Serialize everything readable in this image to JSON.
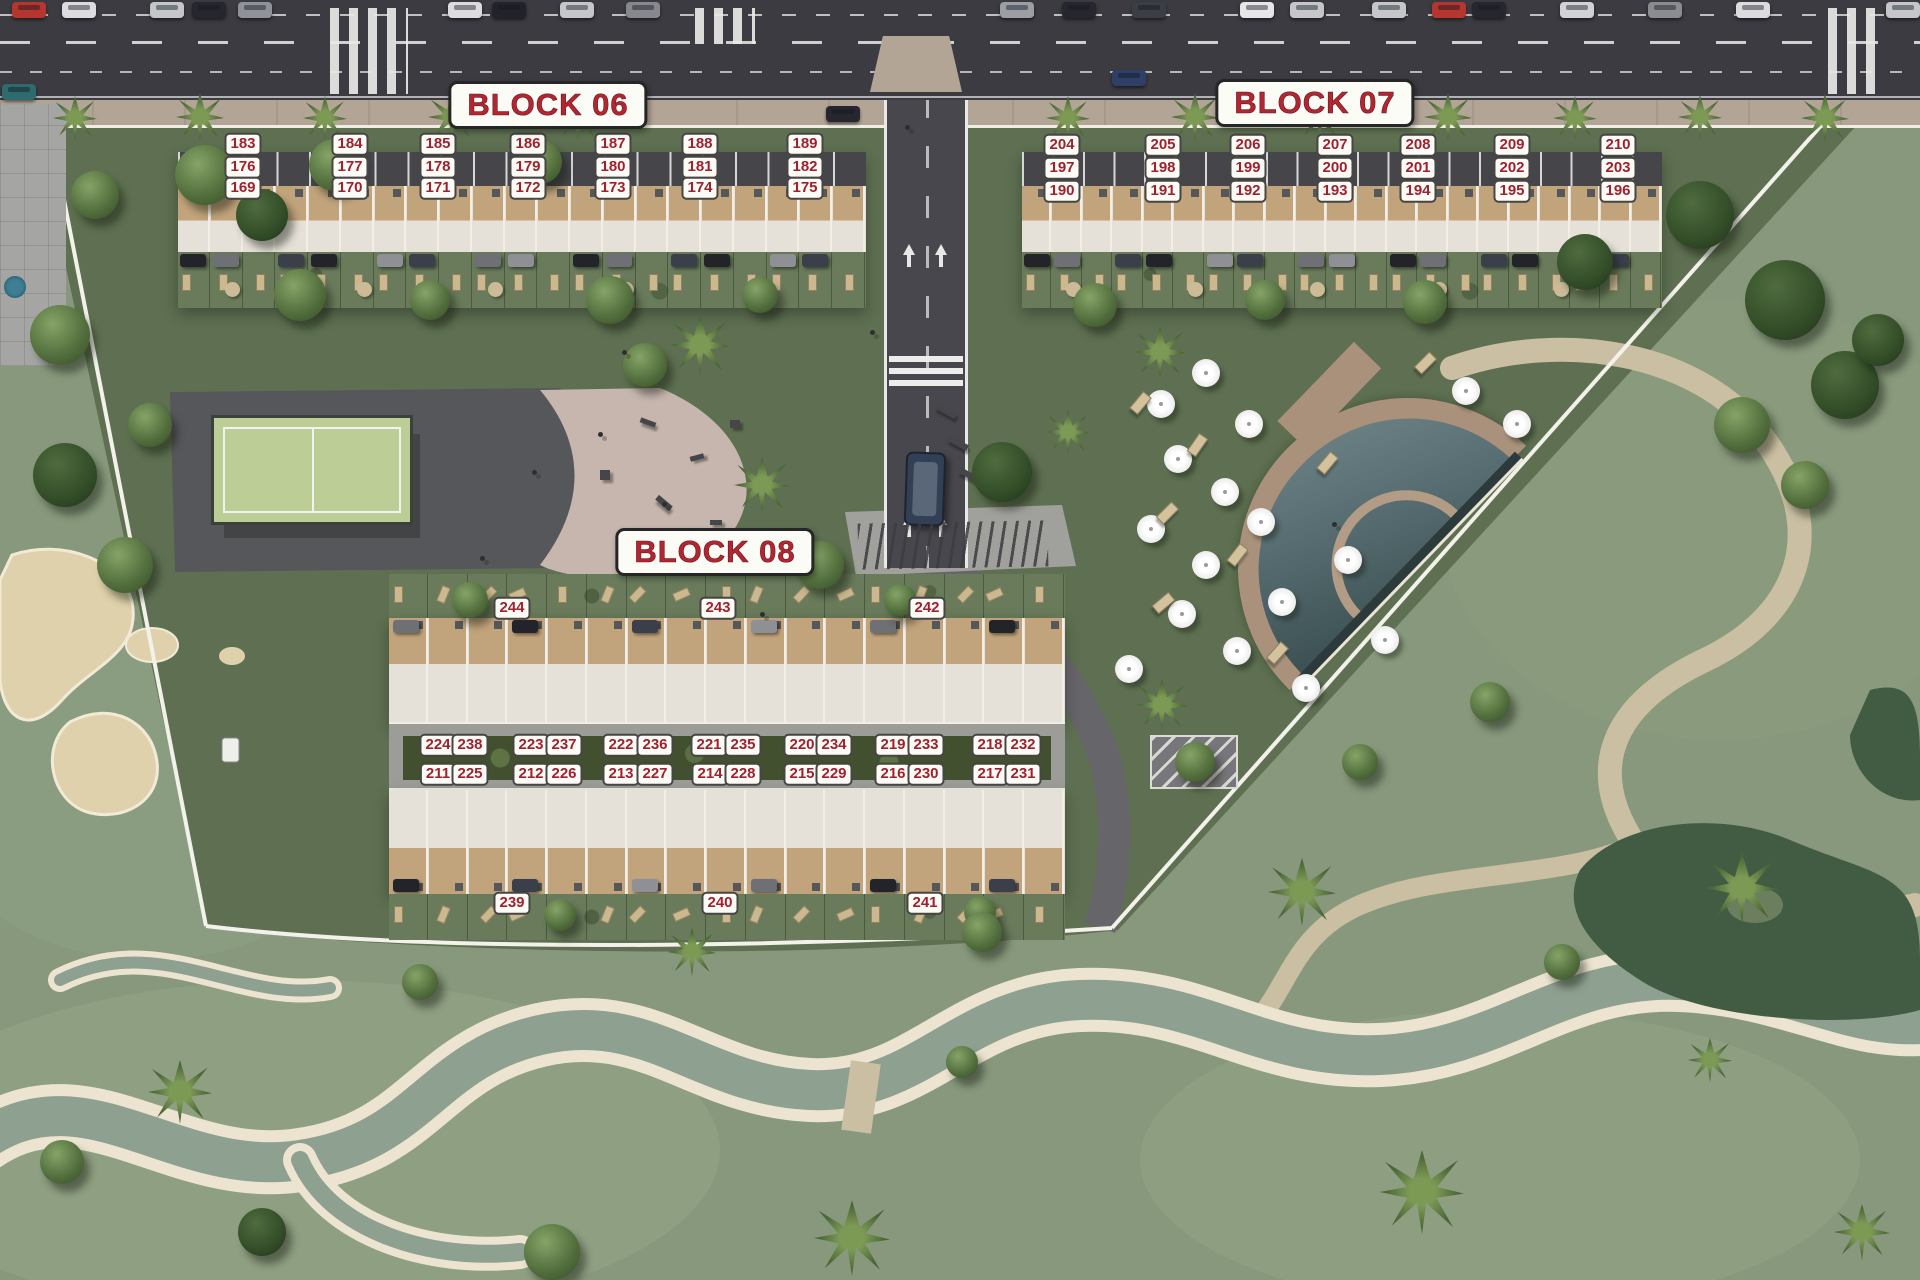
{
  "canvas": {
    "w": 1920,
    "h": 1280
  },
  "colors": {
    "labelred": "#9e2130",
    "titlered": "#b02732",
    "road": "#3b3b41",
    "vroad": "#47474d",
    "sidewalk": "#b3a596",
    "grass": "#87987c",
    "site": "#5e7051",
    "sand": "#ded1ab",
    "path": "#cabfa2",
    "streamwater": "#8ea08f",
    "stone": "#ece4d0",
    "pond": "#415c42",
    "roofw": "#e6e1d8",
    "terrace": "#c2a47c",
    "garden": "#697b5b",
    "hedge": "#42502f",
    "pooldeck": "#a9917b",
    "padel": "#bcce96",
    "plaza": "#a5a5a3"
  },
  "blocks": [
    {
      "id": "06",
      "title": "BLOCK 06",
      "title_pos": {
        "x": 548,
        "y": 105
      },
      "strip": {
        "x": 178,
        "y": 152,
        "w": 688,
        "h": 156
      },
      "unit_count": 21,
      "labels": [
        {
          "n": "183",
          "x": 243,
          "y": 144
        },
        {
          "n": "184",
          "x": 350,
          "y": 144
        },
        {
          "n": "185",
          "x": 438,
          "y": 144
        },
        {
          "n": "186",
          "x": 528,
          "y": 144
        },
        {
          "n": "187",
          "x": 613,
          "y": 144
        },
        {
          "n": "188",
          "x": 700,
          "y": 144
        },
        {
          "n": "189",
          "x": 805,
          "y": 144
        },
        {
          "n": "176",
          "x": 243,
          "y": 167
        },
        {
          "n": "177",
          "x": 350,
          "y": 167
        },
        {
          "n": "178",
          "x": 438,
          "y": 167
        },
        {
          "n": "179",
          "x": 528,
          "y": 167
        },
        {
          "n": "180",
          "x": 613,
          "y": 167
        },
        {
          "n": "181",
          "x": 700,
          "y": 167
        },
        {
          "n": "182",
          "x": 805,
          "y": 167
        },
        {
          "n": "169",
          "x": 243,
          "y": 188
        },
        {
          "n": "170",
          "x": 350,
          "y": 188
        },
        {
          "n": "171",
          "x": 438,
          "y": 188
        },
        {
          "n": "172",
          "x": 528,
          "y": 188
        },
        {
          "n": "173",
          "x": 613,
          "y": 188
        },
        {
          "n": "174",
          "x": 700,
          "y": 188
        },
        {
          "n": "175",
          "x": 805,
          "y": 188
        }
      ]
    },
    {
      "id": "07",
      "title": "BLOCK 07",
      "title_pos": {
        "x": 1315,
        "y": 103
      },
      "strip": {
        "x": 1022,
        "y": 152,
        "w": 640,
        "h": 156
      },
      "unit_count": 21,
      "labels": [
        {
          "n": "204",
          "x": 1062,
          "y": 145
        },
        {
          "n": "205",
          "x": 1163,
          "y": 145
        },
        {
          "n": "206",
          "x": 1248,
          "y": 145
        },
        {
          "n": "207",
          "x": 1335,
          "y": 145
        },
        {
          "n": "208",
          "x": 1418,
          "y": 145
        },
        {
          "n": "209",
          "x": 1512,
          "y": 145
        },
        {
          "n": "210",
          "x": 1618,
          "y": 145
        },
        {
          "n": "197",
          "x": 1062,
          "y": 168
        },
        {
          "n": "198",
          "x": 1163,
          "y": 168
        },
        {
          "n": "199",
          "x": 1248,
          "y": 168
        },
        {
          "n": "200",
          "x": 1335,
          "y": 168
        },
        {
          "n": "201",
          "x": 1418,
          "y": 168
        },
        {
          "n": "202",
          "x": 1512,
          "y": 168
        },
        {
          "n": "203",
          "x": 1618,
          "y": 168
        },
        {
          "n": "190",
          "x": 1062,
          "y": 191
        },
        {
          "n": "191",
          "x": 1163,
          "y": 191
        },
        {
          "n": "192",
          "x": 1248,
          "y": 191
        },
        {
          "n": "193",
          "x": 1335,
          "y": 191
        },
        {
          "n": "194",
          "x": 1418,
          "y": 191
        },
        {
          "n": "195",
          "x": 1512,
          "y": 191
        },
        {
          "n": "196",
          "x": 1618,
          "y": 191
        }
      ]
    },
    {
      "id": "08",
      "title": "BLOCK 08",
      "title_pos": {
        "x": 715,
        "y": 552
      },
      "north": {
        "x": 389,
        "y": 618,
        "w": 676,
        "h": 104
      },
      "south": {
        "x": 389,
        "y": 790,
        "w": 676,
        "h": 104
      },
      "unit_count": 17,
      "labels": [
        {
          "n": "244",
          "x": 512,
          "y": 608
        },
        {
          "n": "243",
          "x": 718,
          "y": 608
        },
        {
          "n": "242",
          "x": 927,
          "y": 608
        },
        {
          "n": "224",
          "x": 438,
          "y": 745
        },
        {
          "n": "238",
          "x": 470,
          "y": 745
        },
        {
          "n": "223",
          "x": 531,
          "y": 745
        },
        {
          "n": "237",
          "x": 564,
          "y": 745
        },
        {
          "n": "222",
          "x": 621,
          "y": 745
        },
        {
          "n": "236",
          "x": 655,
          "y": 745
        },
        {
          "n": "221",
          "x": 709,
          "y": 745
        },
        {
          "n": "235",
          "x": 743,
          "y": 745
        },
        {
          "n": "220",
          "x": 802,
          "y": 745
        },
        {
          "n": "234",
          "x": 834,
          "y": 745
        },
        {
          "n": "219",
          "x": 893,
          "y": 745
        },
        {
          "n": "233",
          "x": 926,
          "y": 745
        },
        {
          "n": "218",
          "x": 990,
          "y": 745
        },
        {
          "n": "232",
          "x": 1023,
          "y": 745
        },
        {
          "n": "211",
          "x": 438,
          "y": 774
        },
        {
          "n": "225",
          "x": 470,
          "y": 774
        },
        {
          "n": "212",
          "x": 531,
          "y": 774
        },
        {
          "n": "226",
          "x": 564,
          "y": 774
        },
        {
          "n": "213",
          "x": 621,
          "y": 774
        },
        {
          "n": "227",
          "x": 655,
          "y": 774
        },
        {
          "n": "214",
          "x": 710,
          "y": 774
        },
        {
          "n": "228",
          "x": 743,
          "y": 774
        },
        {
          "n": "215",
          "x": 802,
          "y": 774
        },
        {
          "n": "229",
          "x": 834,
          "y": 774
        },
        {
          "n": "216",
          "x": 893,
          "y": 774
        },
        {
          "n": "230",
          "x": 926,
          "y": 774
        },
        {
          "n": "217",
          "x": 990,
          "y": 774
        },
        {
          "n": "231",
          "x": 1023,
          "y": 774
        },
        {
          "n": "239",
          "x": 512,
          "y": 903
        },
        {
          "n": "240",
          "x": 720,
          "y": 903
        },
        {
          "n": "241",
          "x": 925,
          "y": 903
        }
      ]
    }
  ],
  "cars_top": [
    {
      "x": 12,
      "c": "#b5362f"
    },
    {
      "x": 62,
      "c": "#dcdcde"
    },
    {
      "x": 150,
      "c": "#c4c6ca"
    },
    {
      "x": 192,
      "c": "#26262e"
    },
    {
      "x": 238,
      "c": "#90929a"
    },
    {
      "x": 448,
      "c": "#dcdcde"
    },
    {
      "x": 492,
      "c": "#22222a"
    },
    {
      "x": 560,
      "c": "#c4c6ca"
    },
    {
      "x": 626,
      "c": "#86888e"
    },
    {
      "x": 1000,
      "c": "#9c9ea4"
    },
    {
      "x": 1062,
      "c": "#26262e"
    },
    {
      "x": 1132,
      "c": "#3c3e46"
    },
    {
      "x": 1240,
      "c": "#e6e6e8"
    },
    {
      "x": 1290,
      "c": "#c4c6ca"
    },
    {
      "x": 1372,
      "c": "#c4c6ca"
    },
    {
      "x": 1432,
      "c": "#b5362f"
    },
    {
      "x": 1472,
      "c": "#26262e"
    },
    {
      "x": 1560,
      "c": "#d0d2d6"
    },
    {
      "x": 1648,
      "c": "#8a8c92"
    },
    {
      "x": 1736,
      "c": "#dcdcde"
    },
    {
      "x": 1886,
      "c": "#c4c6ca"
    }
  ],
  "cars_other": [
    {
      "x": 2,
      "y": 84,
      "c": "#2e6b6e"
    },
    {
      "x": 1112,
      "y": 70,
      "c": "#2f3f66"
    },
    {
      "x": 826,
      "y": 106,
      "c": "#26262e"
    }
  ],
  "trees": [
    [
      75,
      118,
      22,
      "p"
    ],
    [
      200,
      117,
      24,
      "p"
    ],
    [
      325,
      118,
      22,
      "p"
    ],
    [
      452,
      117,
      24,
      "p"
    ],
    [
      578,
      118,
      22,
      "p"
    ],
    [
      1068,
      118,
      22,
      "p"
    ],
    [
      1195,
      117,
      24,
      "p"
    ],
    [
      1320,
      118,
      22,
      "p"
    ],
    [
      1448,
      117,
      24,
      "p"
    ],
    [
      1575,
      118,
      22,
      "p"
    ],
    [
      1700,
      117,
      22,
      "p"
    ],
    [
      1825,
      118,
      24,
      "p"
    ],
    [
      205,
      175,
      30,
      "r"
    ],
    [
      262,
      215,
      26,
      "d"
    ],
    [
      335,
      165,
      26,
      "r"
    ],
    [
      540,
      162,
      22,
      "r"
    ],
    [
      300,
      295,
      26,
      "r"
    ],
    [
      610,
      300,
      24,
      "r"
    ],
    [
      95,
      195,
      24,
      "r"
    ],
    [
      60,
      335,
      30,
      "r"
    ],
    [
      150,
      425,
      22,
      "r"
    ],
    [
      65,
      475,
      32,
      "d"
    ],
    [
      125,
      565,
      28,
      "r"
    ],
    [
      700,
      345,
      30,
      "p"
    ],
    [
      645,
      365,
      22,
      "r"
    ],
    [
      762,
      485,
      28,
      "p"
    ],
    [
      820,
      565,
      24,
      "r"
    ],
    [
      1002,
      472,
      30,
      "d"
    ],
    [
      1095,
      305,
      22,
      "r"
    ],
    [
      1265,
      300,
      20,
      "r"
    ],
    [
      1425,
      302,
      22,
      "r"
    ],
    [
      1585,
      262,
      28,
      "d"
    ],
    [
      1700,
      215,
      34,
      "d"
    ],
    [
      1785,
      300,
      40,
      "d"
    ],
    [
      1845,
      385,
      34,
      "d"
    ],
    [
      1742,
      425,
      28,
      "r"
    ],
    [
      1805,
      485,
      24,
      "r"
    ],
    [
      1878,
      340,
      26,
      "d"
    ],
    [
      1160,
      352,
      26,
      "p"
    ],
    [
      1068,
      432,
      22,
      "p"
    ],
    [
      1162,
      705,
      26,
      "p"
    ],
    [
      1195,
      762,
      20,
      "r"
    ],
    [
      470,
      600,
      18,
      "r"
    ],
    [
      900,
      600,
      16,
      "r"
    ],
    [
      560,
      915,
      16,
      "r"
    ],
    [
      980,
      912,
      16,
      "r"
    ],
    [
      430,
      300,
      20,
      "r"
    ],
    [
      760,
      295,
      18,
      "r"
    ],
    [
      180,
      1092,
      32,
      "p"
    ],
    [
      420,
      982,
      18,
      "r"
    ],
    [
      692,
      952,
      24,
      "p"
    ],
    [
      852,
      1238,
      38,
      "p"
    ],
    [
      982,
      932,
      20,
      "r"
    ],
    [
      1302,
      892,
      34,
      "p"
    ],
    [
      1422,
      1192,
      42,
      "p"
    ],
    [
      1562,
      962,
      18,
      "r"
    ],
    [
      1742,
      888,
      36,
      "p"
    ],
    [
      1862,
      1232,
      28,
      "p"
    ],
    [
      262,
      1232,
      24,
      "d"
    ],
    [
      62,
      1162,
      22,
      "r"
    ],
    [
      552,
      1252,
      28,
      "r"
    ],
    [
      1490,
      702,
      20,
      "r"
    ],
    [
      1360,
      762,
      18,
      "r"
    ],
    [
      962,
      1062,
      16,
      "r"
    ],
    [
      1710,
      1060,
      22,
      "p"
    ]
  ],
  "parasols": [
    [
      1161,
      404
    ],
    [
      1206,
      373
    ],
    [
      1249,
      424
    ],
    [
      1178,
      459
    ],
    [
      1225,
      492
    ],
    [
      1151,
      529
    ],
    [
      1206,
      565
    ],
    [
      1261,
      522
    ],
    [
      1182,
      614
    ],
    [
      1237,
      651
    ],
    [
      1282,
      602
    ],
    [
      1129,
      669
    ],
    [
      1306,
      688
    ],
    [
      1466,
      391
    ],
    [
      1517,
      424
    ],
    [
      1348,
      560
    ],
    [
      1385,
      640
    ]
  ],
  "loungers": [
    [
      1135,
      392,
      40
    ],
    [
      1192,
      434,
      35
    ],
    [
      1162,
      502,
      45
    ],
    [
      1232,
      544,
      38
    ],
    [
      1158,
      592,
      50
    ],
    [
      1272,
      642,
      42
    ],
    [
      1322,
      452,
      40
    ],
    [
      1420,
      352,
      45
    ]
  ],
  "people": [
    [
      532,
      470
    ],
    [
      598,
      432
    ],
    [
      662,
      502
    ],
    [
      480,
      556
    ],
    [
      905,
      125
    ],
    [
      1242,
      142
    ],
    [
      760,
      612
    ],
    [
      1332,
      522
    ],
    [
      622,
      350
    ],
    [
      870,
      330
    ]
  ],
  "equip": [
    [
      640,
      420,
      16,
      5,
      20
    ],
    [
      690,
      455,
      14,
      5,
      -15
    ],
    [
      655,
      500,
      18,
      6,
      40
    ],
    [
      710,
      520,
      12,
      5,
      0
    ],
    [
      600,
      470,
      10,
      10,
      0
    ],
    [
      730,
      420,
      10,
      8,
      0
    ],
    [
      935,
      408,
      22,
      6,
      28
    ],
    [
      947,
      440,
      22,
      6,
      28
    ],
    [
      958,
      472,
      22,
      6,
      28
    ]
  ]
}
